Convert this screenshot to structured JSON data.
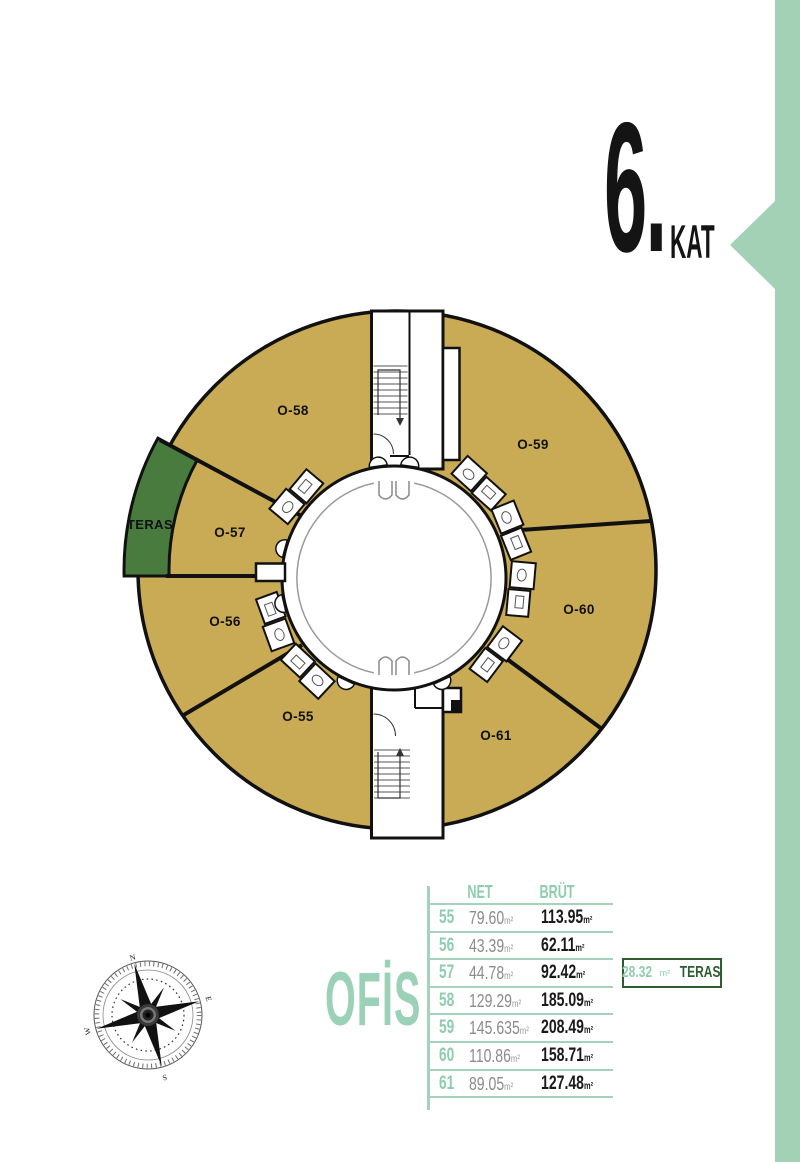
{
  "header": {
    "floor_number": "6.",
    "floor_label": "KAT"
  },
  "plan": {
    "unit_labels": {
      "o55": "O-55",
      "o56": "O-56",
      "o57": "O-57",
      "o58": "O-58",
      "o59": "O-59",
      "o60": "O-60",
      "o61": "O-61",
      "teras": "TERAS"
    }
  },
  "legend": {
    "title": "OFİS"
  },
  "table": {
    "headers": {
      "net": "NET",
      "brut": "BRÜT"
    },
    "unit": "m²",
    "rows": [
      {
        "no": "55",
        "net": "79.60",
        "brut": "113.95"
      },
      {
        "no": "56",
        "net": "43.39",
        "brut": "62.11"
      },
      {
        "no": "57",
        "net": "44.78",
        "brut": "92.42"
      },
      {
        "no": "58",
        "net": "129.29",
        "brut": "185.09"
      },
      {
        "no": "59",
        "net": "145.635",
        "brut": "208.49"
      },
      {
        "no": "60",
        "net": "110.86",
        "brut": "158.71"
      },
      {
        "no": "61",
        "net": "89.05",
        "brut": "127.48"
      }
    ],
    "teras_note": {
      "value": "28.32",
      "unit": "m²",
      "label": "TERAS"
    }
  },
  "compass": {
    "n": "N",
    "e": "E",
    "s": "S",
    "w": "W"
  },
  "colors": {
    "mint": "#a3d1b6",
    "mint_text": "#8ecdae",
    "dark_green": "#2d5c30",
    "tan": "#c9ab55",
    "teras_green": "#4a7b3e",
    "ink": "#111111",
    "gray_value": "#8b8b8b"
  }
}
